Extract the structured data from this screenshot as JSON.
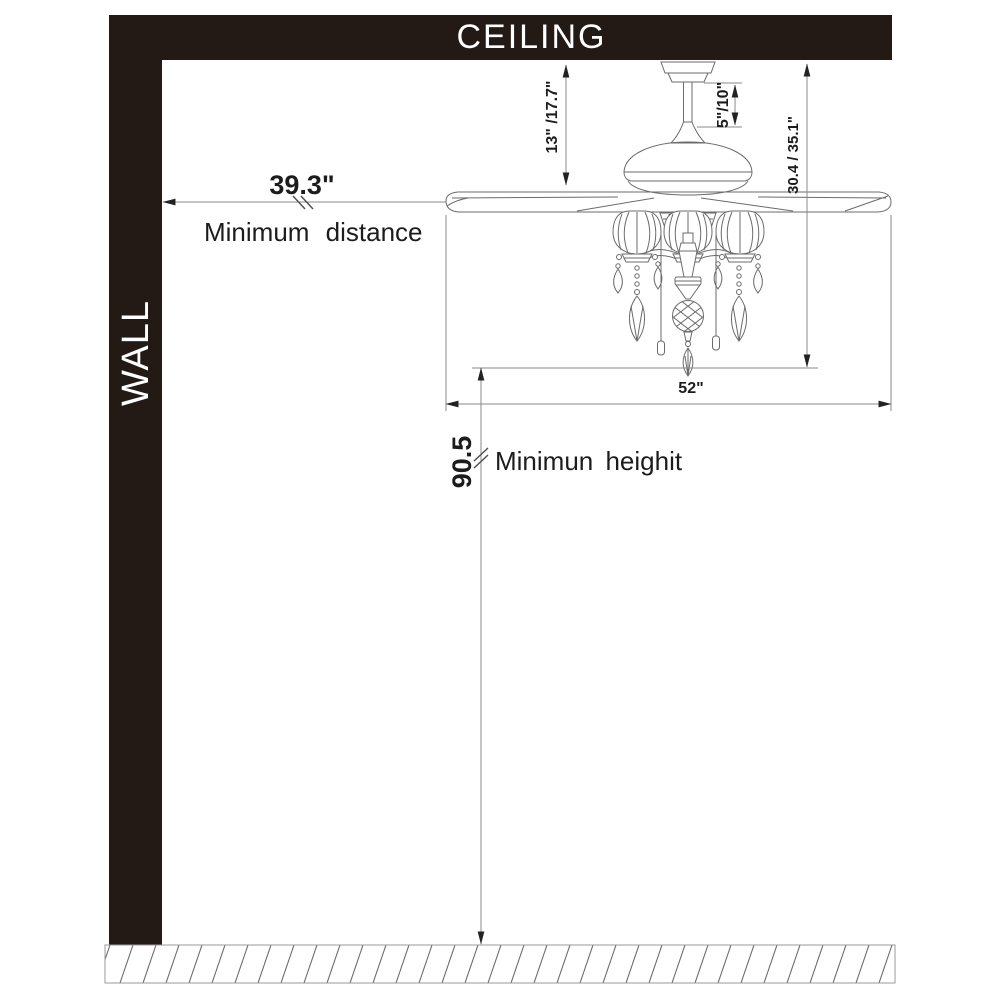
{
  "diagram": {
    "title_context": "Ceiling fan installation clearance diagram",
    "ceiling_label": "CEILING",
    "wall_label": "WALL",
    "dimensions": {
      "min_distance": {
        "value": "39.3\"",
        "label": "Minimum distance"
      },
      "min_height": {
        "value": "90.5",
        "label": "Minimun heighit"
      },
      "hanger_height": "13\" /17.7\"",
      "downrod_length": "5\"/10\"",
      "total_height": "30.4 / 35.1\"",
      "blade_span": "52\""
    },
    "colors": {
      "structure": "#241a15",
      "line": "#6b6b6b",
      "dimline": "#8a8a8a",
      "text": "#1c1c1c"
    }
  }
}
